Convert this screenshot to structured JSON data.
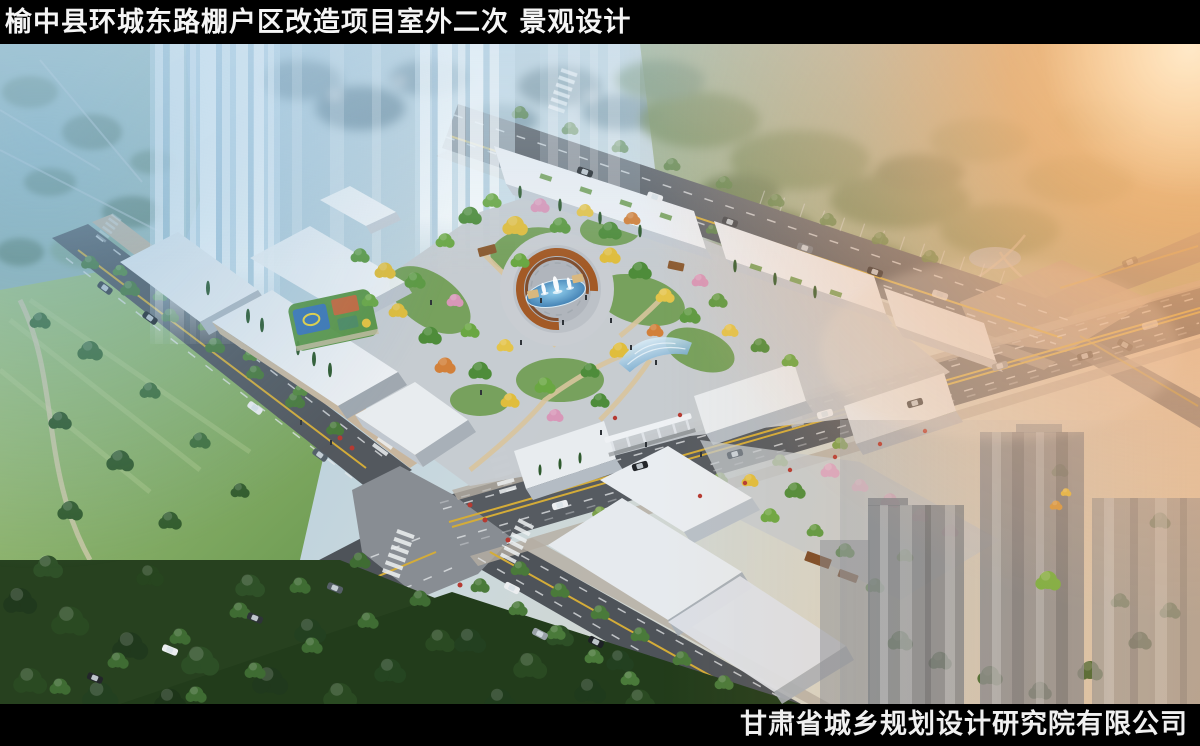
{
  "header": {
    "title": "榆中县环城东路棚户区改造项目室外二次 景观设计"
  },
  "footer": {
    "credit": "甘肃省城乡规划设计研究院有限公司"
  },
  "palette": {
    "bar_black": "#000000",
    "title_white": "#f5f5f5",
    "haze_blue": "#76aed4",
    "sunset_orange": "#f6a75f",
    "road_gray": "#53585e",
    "building_white": "#eef1f4",
    "foliage_green": "#5d9a42",
    "autumn_yellow": "#e0bd3c",
    "autumn_orange": "#d2803a",
    "blossom_pink": "#d897b8",
    "water_blue": "#4f9fd4",
    "pergola_rust": "#a35a26",
    "park_dark_green": "#26441f",
    "lawn_green": "#7fae62"
  }
}
